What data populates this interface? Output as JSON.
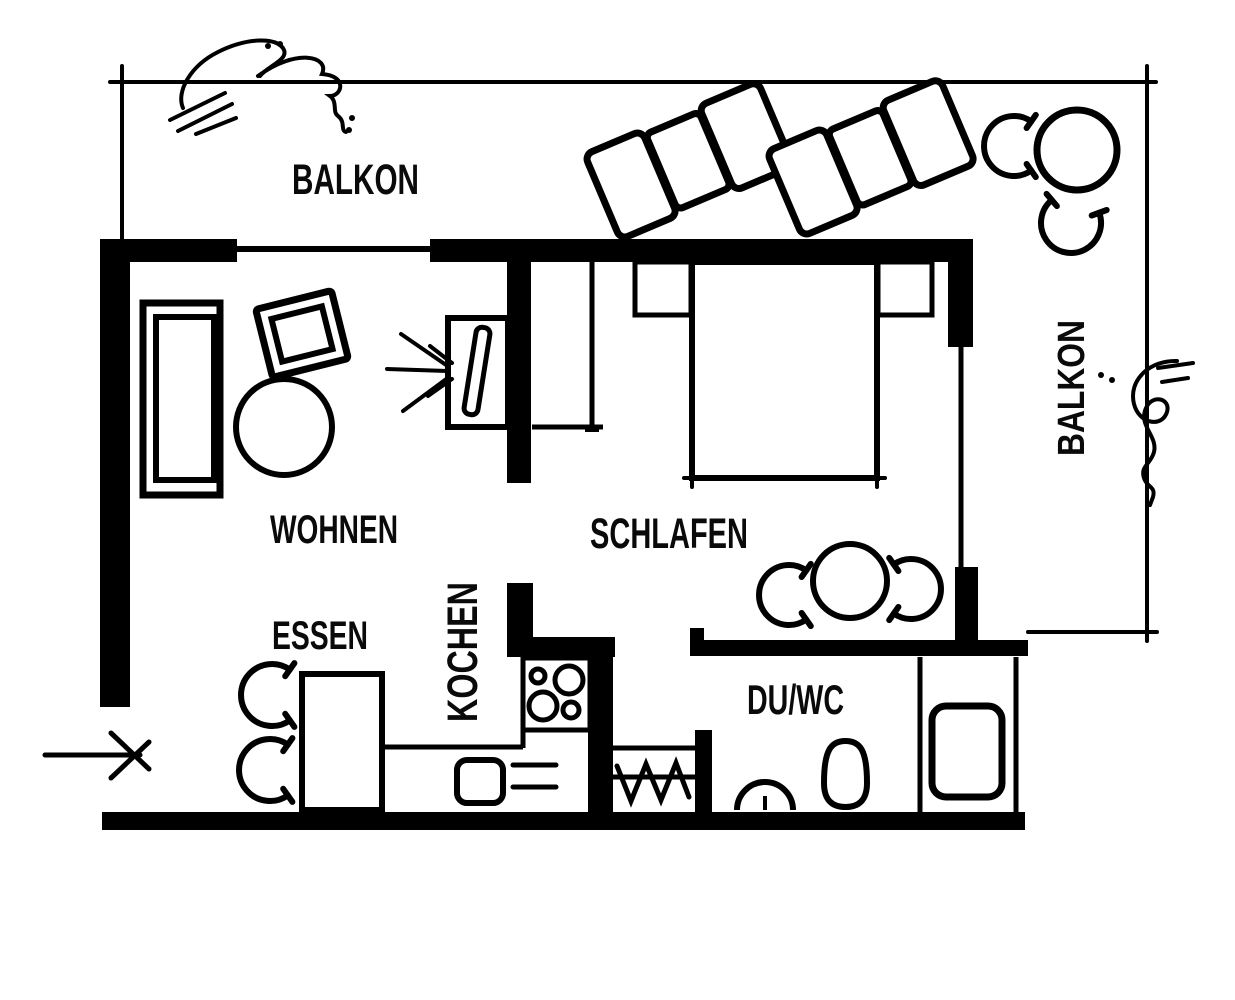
{
  "plan": {
    "colors": {
      "ink": "#000000",
      "background": "#ffffff"
    },
    "rooms": {
      "balkon_top": {
        "label": "BALKON"
      },
      "balkon_right": {
        "label": "BALKON"
      },
      "wohnen": {
        "label": "WOHNEN"
      },
      "schlafen": {
        "label": "SCHLAFEN"
      },
      "essen": {
        "label": "ESSEN"
      },
      "kochen": {
        "label": "KOCHEN"
      },
      "duwc": {
        "label": "DU/WC"
      }
    },
    "symbols": {
      "entrance_arrow": "arrow-right",
      "plants": "sketched-plant-scribbles"
    }
  }
}
